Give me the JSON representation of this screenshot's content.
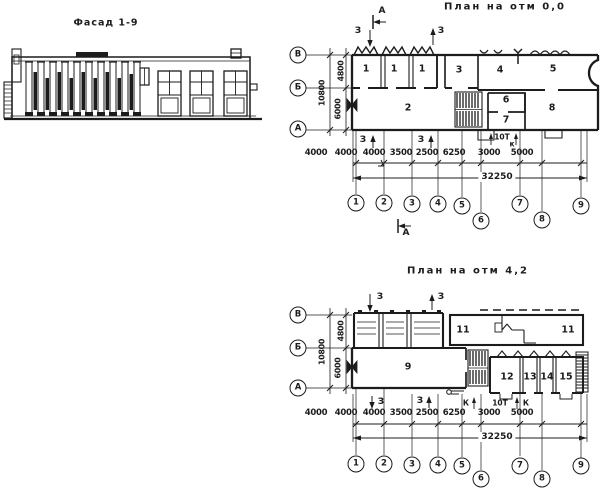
{
  "sheet": {
    "facade_title": "Фасад 1-9",
    "plan0_title": "План на отм 0,0",
    "plan42_title": "План на отм 4,2"
  },
  "grid": {
    "rows": [
      "В",
      "Б",
      "А"
    ],
    "columns": [
      "1",
      "2",
      "3",
      "4",
      "5",
      "6",
      "7",
      "8",
      "9"
    ],
    "h_dims": [
      "4000",
      "4000",
      "4000",
      "3500",
      "2500",
      "6250",
      "3000",
      "5000"
    ],
    "total": "32250",
    "v_dims": [
      "4800",
      "6000",
      "10800"
    ]
  },
  "plan0": {
    "rooms": [
      "1",
      "1",
      "1",
      "3",
      "4",
      "5",
      "2",
      "6",
      "7",
      "8"
    ]
  },
  "plan42": {
    "rooms": [
      "11",
      "11",
      "9",
      "12",
      "13",
      "14",
      "15"
    ]
  },
  "annotations": {
    "section_a": "А",
    "section_z": "З",
    "section_k": "К",
    "section_k_small": "к",
    "hoist": "10Т"
  },
  "colors": {
    "ink": "#1c1c1c",
    "paper": "#ffffff"
  }
}
